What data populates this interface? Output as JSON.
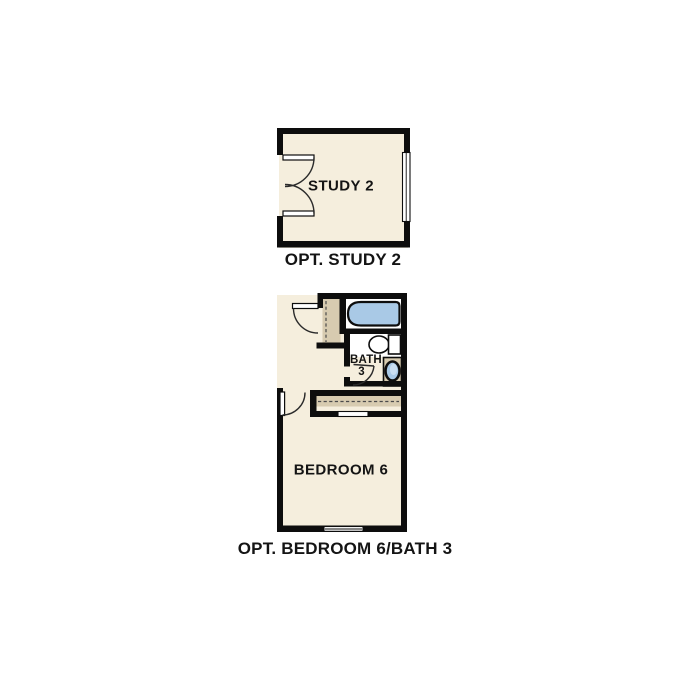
{
  "colors": {
    "wall": "#0d0d0d",
    "line": "#2b2b2b",
    "dash": "#4a4a4a",
    "floor_cream": "#f5eedd",
    "cabinet_tan": "#d7cbb0",
    "fixture_blue": "#a9c9e6",
    "fixture_blue_light": "#cfe2f2",
    "text": "#141414"
  },
  "plans": [
    {
      "id": "study",
      "room_label": "STUDY 2",
      "caption": "OPT. STUDY 2"
    },
    {
      "id": "bedroom-bath",
      "room_label": "BEDROOM 6",
      "bath_label_line1": "BATH",
      "bath_label_line2": "3",
      "caption": "OPT. BEDROOM 6/BATH 3"
    }
  ]
}
